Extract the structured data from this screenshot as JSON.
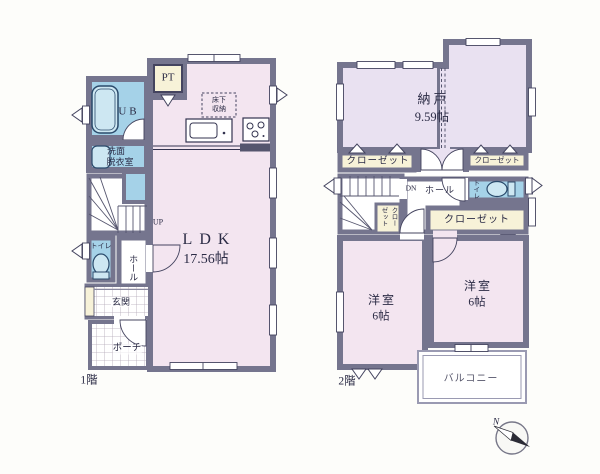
{
  "colors": {
    "wall": "#75758e",
    "room_pink": "#f3e5f0",
    "room_lavender": "#e9e1f1",
    "wet_blue": "#a5d2e8",
    "fixture_blue": "#cde7f2",
    "closet_cream": "#f7f2d8",
    "line_dark": "#3c3c58",
    "background": "#fdfdfa"
  },
  "floor1": {
    "floor_label": "1階",
    "pt": "PT",
    "ub": "UB",
    "underfloor_line1": "床下",
    "underfloor_line2": "収納",
    "washroom_line1": "洗面",
    "washroom_line2": "脱衣室",
    "stairs_up": "UP",
    "ldk_name": "LDK",
    "ldk_size": "17.56帖",
    "toilet": "トイレ",
    "hall": "ホール",
    "entrance": "玄関",
    "porch": "ポーチ"
  },
  "floor2": {
    "floor_label": "2階",
    "storage_name": "納戸",
    "storage_size": "9.59帖",
    "closet_left": "クローゼット",
    "closet_right": "クローゼット",
    "closet_small": "クローゼット",
    "closet_master": "クローゼット",
    "stairs_down": "DN",
    "hall": "ホール",
    "toilet": "トイレ",
    "bedroom_left_name": "洋室",
    "bedroom_left_size": "6帖",
    "bedroom_right_name": "洋室",
    "bedroom_right_size": "6帖",
    "balcony": "バルコニー"
  },
  "compass": {
    "north_label": "N"
  }
}
